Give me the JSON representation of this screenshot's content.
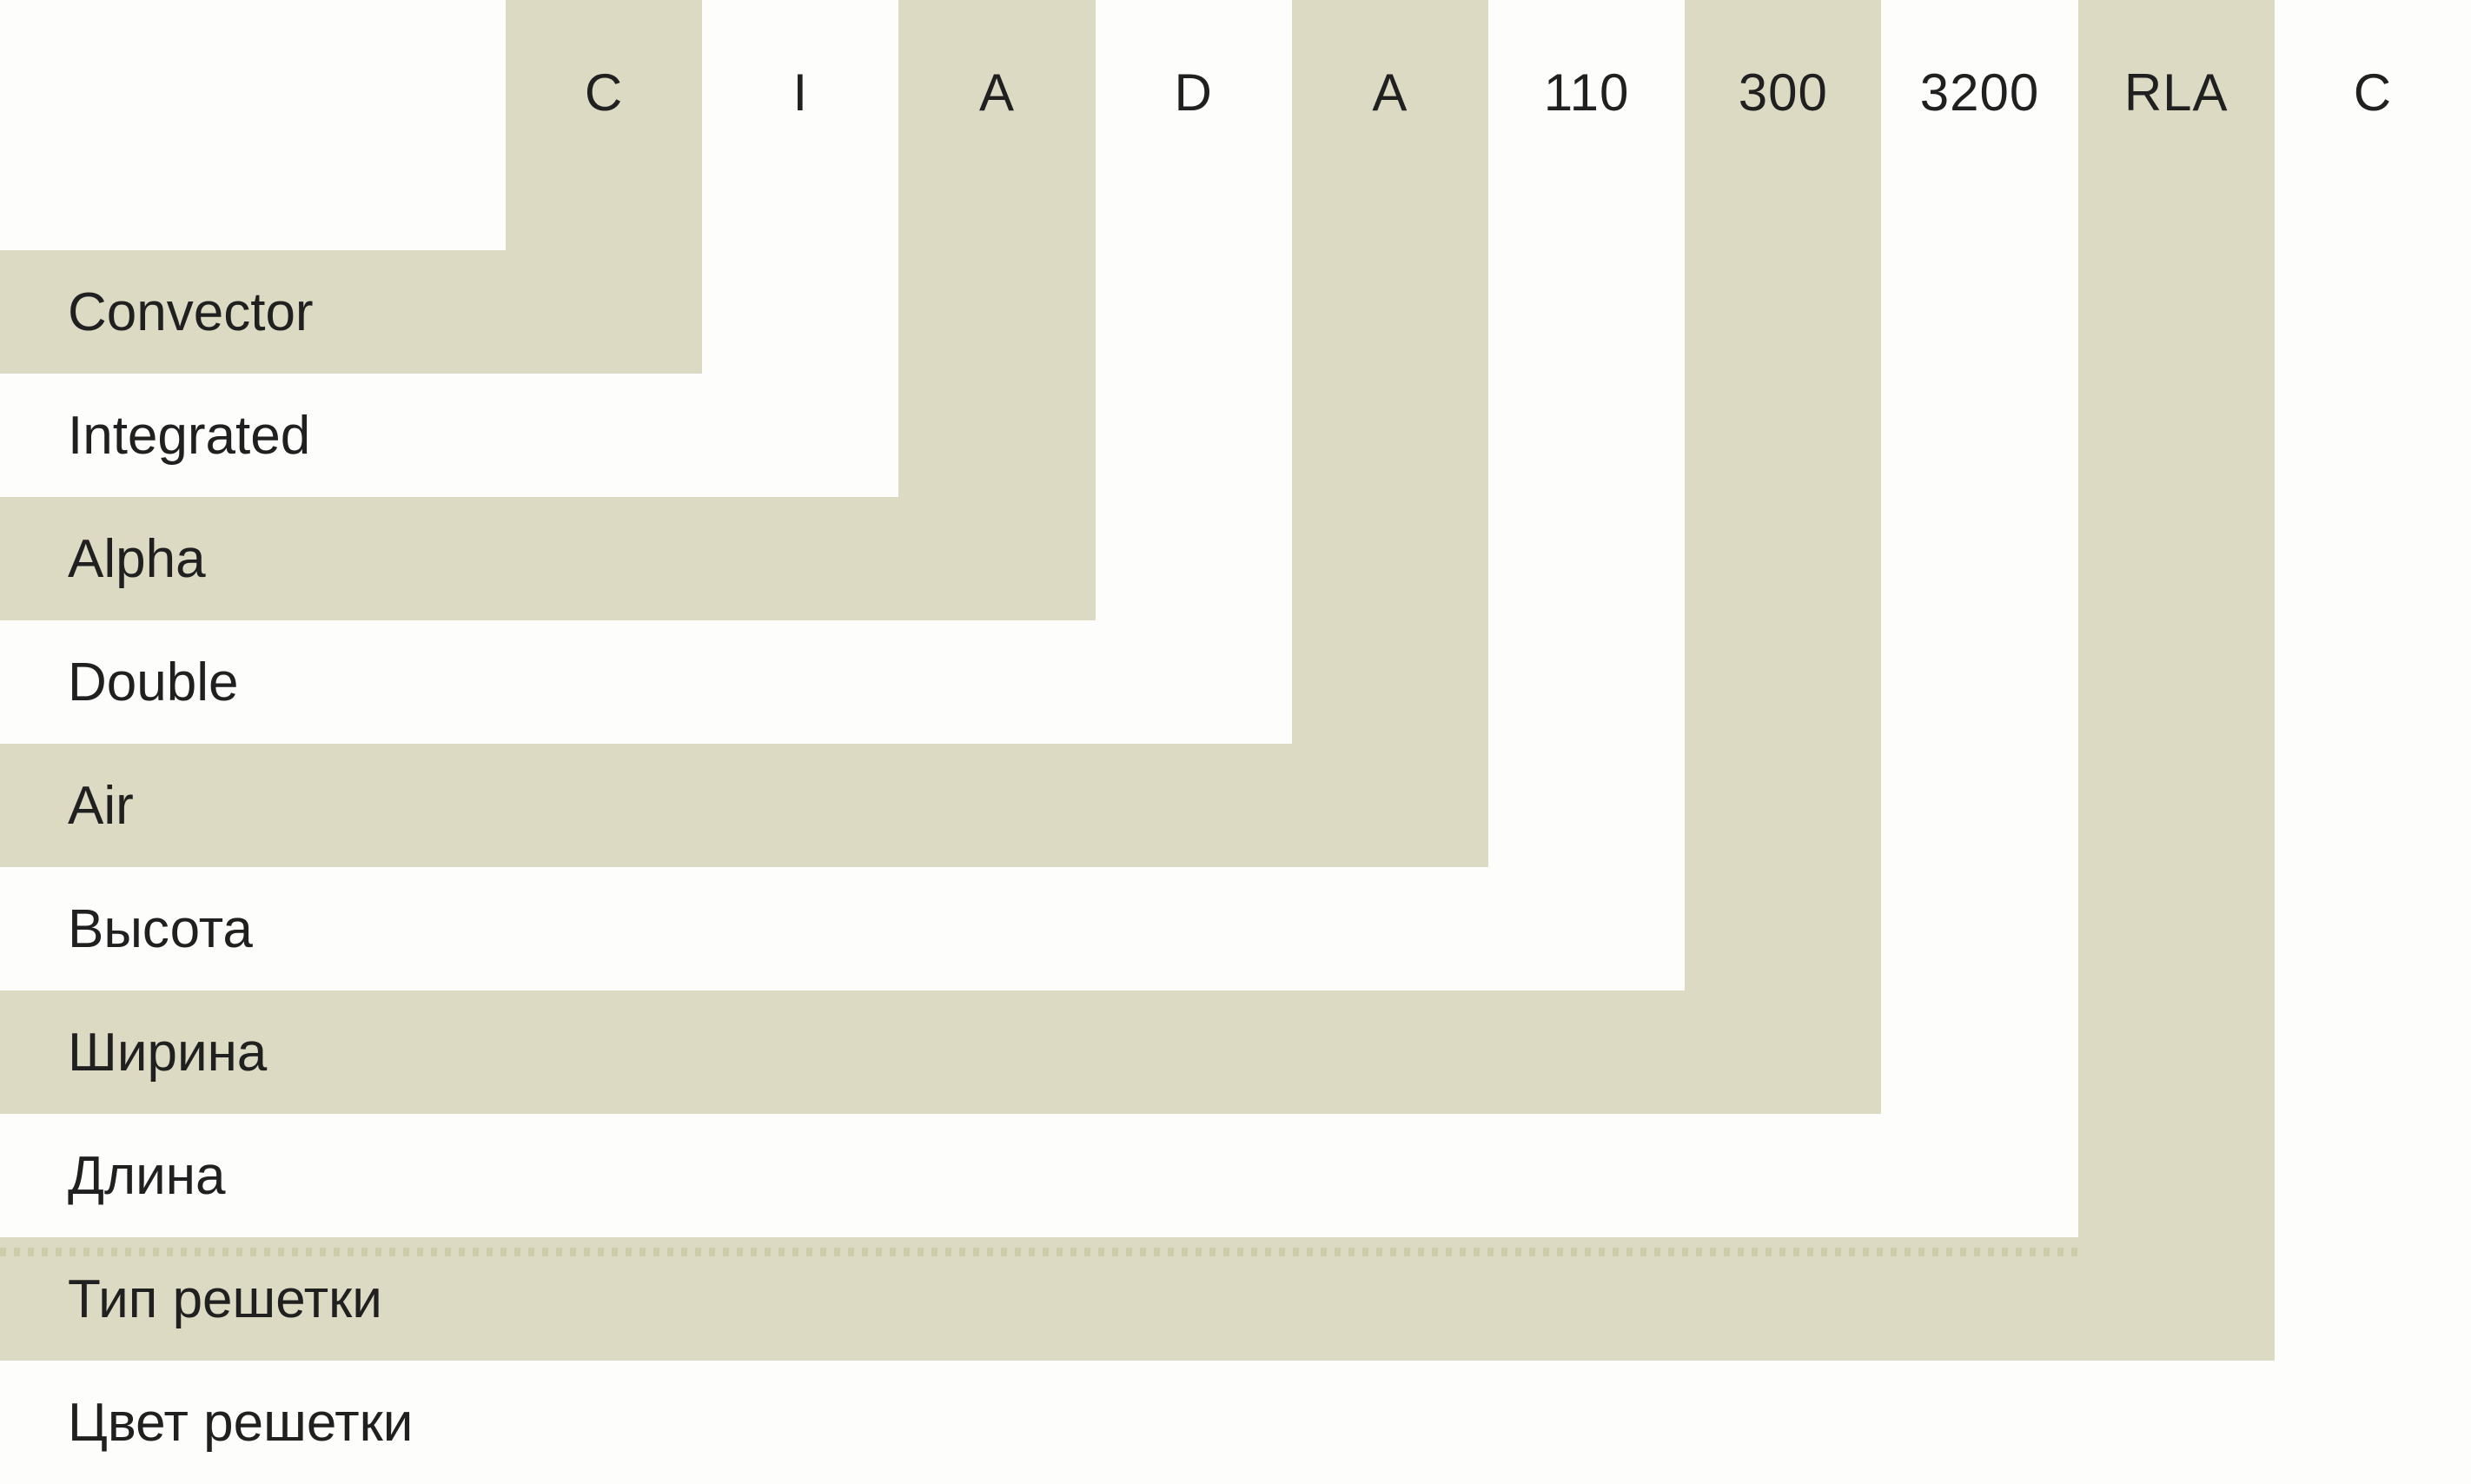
{
  "diagram": {
    "title": "Convector model code nomenclature"
  },
  "model_code": {
    "segments": [
      {
        "code": "C",
        "label": "Convector"
      },
      {
        "code": "I",
        "label": "Integrated"
      },
      {
        "code": "A",
        "label": "Alpha"
      },
      {
        "code": "D",
        "label": "Double"
      },
      {
        "code": "A",
        "label": "Air"
      },
      {
        "code": "110",
        "label": "Высота"
      },
      {
        "code": "300",
        "label": "Ширина"
      },
      {
        "code": "3200",
        "label": "Длина"
      },
      {
        "code": "RLA",
        "label": "Тип решетки"
      },
      {
        "code": "C",
        "label": "Цвет решетки"
      }
    ]
  },
  "colors": {
    "band_beige": "#dcdac2",
    "background": "#fdfdfc",
    "text": "#202020",
    "dash": "#cfcda9"
  }
}
